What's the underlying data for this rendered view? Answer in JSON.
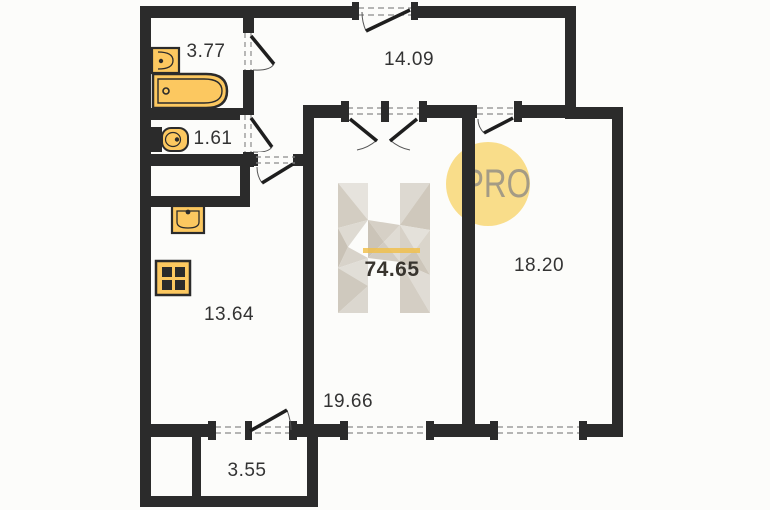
{
  "floor_plan": {
    "total_area": "74.65",
    "badge_text": "PRO",
    "watermark_letter": "H",
    "rooms": [
      {
        "id": "bathroom",
        "area": "3.77"
      },
      {
        "id": "toilet-room",
        "area": "1.61"
      },
      {
        "id": "hallway",
        "area": "14.09"
      },
      {
        "id": "kitchen",
        "area": "13.64"
      },
      {
        "id": "living-room",
        "area": "19.66"
      },
      {
        "id": "bedroom",
        "area": "18.20"
      },
      {
        "id": "balcony",
        "area": "3.55"
      }
    ],
    "fixtures": [
      "bathtub",
      "wash-basin",
      "toilet",
      "kitchen-sink",
      "stove"
    ],
    "colors": {
      "walls": "#2b2b2b",
      "fixture_fill": "#fcc860",
      "badge_circle": "#f8d97d",
      "badge_text": "#a49b85",
      "accent_line": "#f0bf4e"
    }
  }
}
